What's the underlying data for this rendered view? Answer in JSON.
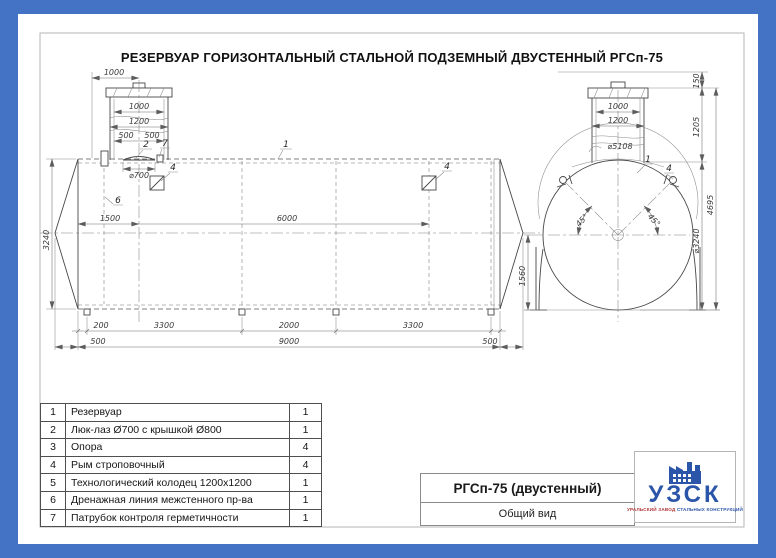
{
  "title": "РЕЗЕРВУАР ГОРИЗОНТАЛЬНЫЙ СТАЛЬНОЙ ПОДЗЕМНЫЙ ДВУСТЕННЫЙ РГСп-75",
  "colors": {
    "border_blue": "#4472c4",
    "logo_blue": "#2b55a8",
    "logo_red": "#b03434"
  },
  "side_view": {
    "dim_top_offset": "1000",
    "dim_well_inner": "1000",
    "dim_well_outer": "1200",
    "dim_half_left": "500",
    "dim_half_right": "500",
    "dim_hatch": "⌀700",
    "dim_height": "3240",
    "dim_end_to_well": "1500",
    "dim_between_ryms": "6000",
    "dim_end_to_support": "200",
    "dim_support_span_1": "3300",
    "dim_support_span_mid": "2000",
    "dim_support_span_2": "3300",
    "dim_cone_left": "500",
    "dim_cylinder": "9000",
    "dim_cone_right": "500",
    "callout_tank": "1",
    "callout_hatch": "2",
    "callout_rym_1": "4",
    "callout_rym_2": "4",
    "callout_drain": "6",
    "callout_nozzle": "7"
  },
  "end_view": {
    "dim_cover_height": "150",
    "dim_neck_inner": "1000",
    "dim_neck_outer": "1200",
    "dim_arc": "⌀5108",
    "dim_neck_depth": "1205",
    "dim_total_height": "4695",
    "dim_axis_to_base": "1560",
    "dim_shell": "⌀3240",
    "angle_left": "45°",
    "angle_right": "45°",
    "callout_tank": "1",
    "callout_rym": "4"
  },
  "parts_table": {
    "rows": [
      {
        "num": "1",
        "name": "Резервуар",
        "qty": "1"
      },
      {
        "num": "2",
        "name": "Люк-лаз Ø700 с крышкой Ø800",
        "qty": "1"
      },
      {
        "num": "3",
        "name": "Опора",
        "qty": "4"
      },
      {
        "num": "4",
        "name": "Рым строповочный",
        "qty": "4"
      },
      {
        "num": "5",
        "name": "Технологический колодец 1200х1200",
        "qty": "1"
      },
      {
        "num": "6",
        "name": "Дренажная линия межстенного пр-ва",
        "qty": "1"
      },
      {
        "num": "7",
        "name": "Патрубок контроля герметичности",
        "qty": "1"
      }
    ]
  },
  "title_block": {
    "model": "РГСп-75 (двустенный)",
    "view_name": "Общий вид"
  },
  "logo": {
    "abbr": "УЗСК",
    "tagline_left": "УРАЛЬСКИЙ ЗАВОД",
    "tagline_right": "СТАЛЬНЫХ КОНСТРУКЦИЙ"
  }
}
